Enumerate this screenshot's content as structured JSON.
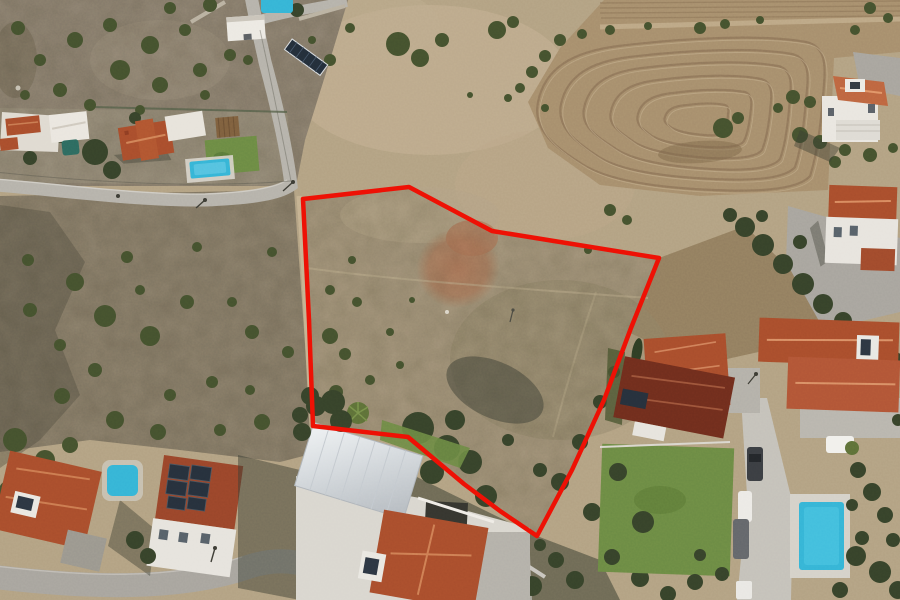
{
  "image": {
    "kind": "aerial-drone-photograph",
    "description": "Top-down aerial photo of a Mediterranean residential neighborhood; an undeveloped scrubland plot is outlined with a red boundary line. Villas with terracotta roofs, solar panels, swimming pools, roads and a terraced plowed field surround the plot.",
    "width": 900,
    "height": 600
  },
  "annotation": {
    "plot_boundary": {
      "color": "#ee1105",
      "stroke_width": 4.5,
      "points": [
        [
          303,
          199
        ],
        [
          409,
          187
        ],
        [
          492,
          231
        ],
        [
          659,
          258
        ],
        [
          631,
          328
        ],
        [
          604,
          400
        ],
        [
          572,
          470
        ],
        [
          537,
          536
        ],
        [
          500,
          511
        ],
        [
          464,
          484
        ],
        [
          408,
          437
        ],
        [
          313,
          426
        ],
        [
          309,
          320
        ],
        [
          303,
          199
        ]
      ]
    }
  },
  "palette": {
    "terrain_tan": "#b2a183",
    "scrub_gray": "#8c8171",
    "slope_gray": "#887d6a",
    "plot_fill": "#9e9078",
    "plowed_field": "#a68e6d",
    "furrow": "#8a7056",
    "road_gray": "#b5b2ab",
    "road_light": "#c4c1ba",
    "road_dark": "#a7a49e",
    "roof_terracotta": "#a84d2c",
    "roof_bright": "#bd6540",
    "roof_dark_red": "#6f2d1d",
    "pool_water": "#35b4d6",
    "lawn_green": "#6b8a44",
    "tree_green": "#44512e",
    "tree_dark": "#36422a",
    "red_dirt": "#b0795b",
    "metal_roof_light": "#eef1f3",
    "metal_roof_dark": "#b7bdc3",
    "shadow": "#3a3d33",
    "boundary_color": "#ee1105"
  },
  "scene_objects": [
    "outlined-vacant-plot",
    "scrub-hillside-northwest",
    "terraced-plowed-field-northeast",
    "gatehouse-and-gate",
    "hillside-solar-array",
    "west-villas-with-gardens",
    "garden-swimming-pool-west",
    "small-dark-plunge-pool",
    "main-road-west",
    "access-road-north",
    "northeast-two-story-villa",
    "east-villa-with-gravel-drive",
    "east-terracotta-roof-houses",
    "dark-red-roof-house-with-lawn",
    "southwest-houses-with-solar-panels",
    "construction-villa-metal-roof",
    "south-terracotta-roof-house",
    "bottom-left-road",
    "bottom-right-road-with-cars",
    "swimming-pool-southwest",
    "swimming-pool-southeast",
    "parked-cars",
    "utility-poles-and-wires"
  ]
}
